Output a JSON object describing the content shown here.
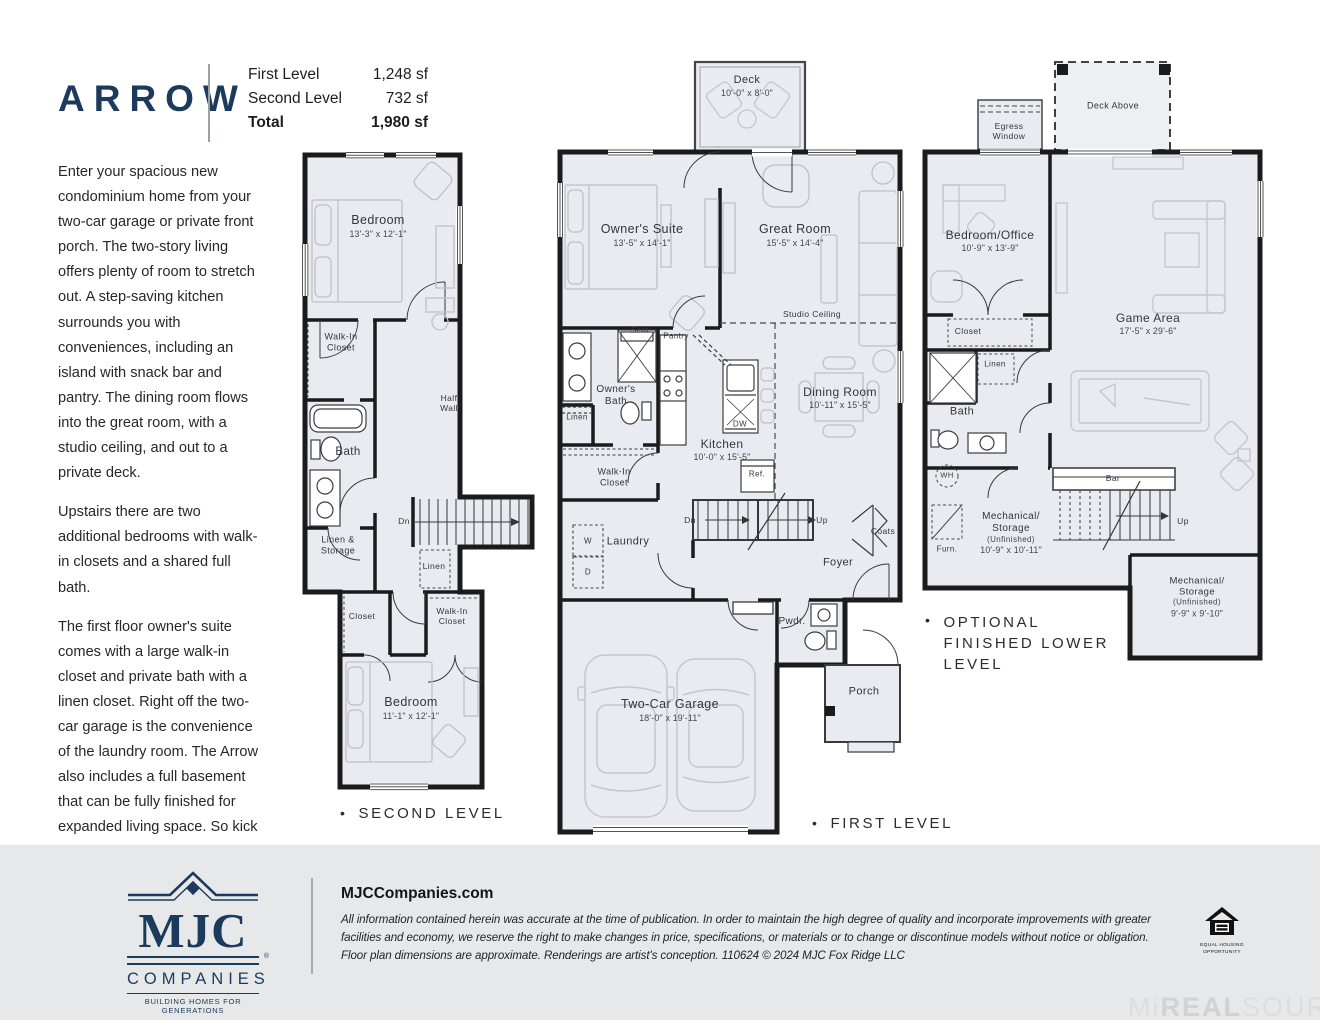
{
  "bullet": "•",
  "header": {
    "title": "ARROW",
    "stats": [
      {
        "label": "First Level",
        "value": "1,248 sf"
      },
      {
        "label": "Second Level",
        "value": "732 sf"
      },
      {
        "label": "Total",
        "value": "1,980 sf"
      }
    ]
  },
  "description": {
    "p1": "Enter your spacious new condominium home from your two-car garage or private front porch. The two-story living offers plenty of room to stretch out. A step-saving kitchen surrounds you with conveniences, including an island with snack bar and pantry. The dining room flows into the great room, with a studio ceiling, and out to a private deck.",
    "p2": "Upstairs there are two additional bedrooms with walk-in closets and a shared full bath.",
    "p3": "The first floor owner's suite comes with a large walk-in closet and private bath with a linen closet. Right off the two-car garage is the convenience of the laundry room. The Arrow also includes a full basement that can be fully finished for expanded living space. So kick off your shoes and feel right at home!"
  },
  "plans": {
    "second": {
      "caption": "SECOND LEVEL",
      "bedroom1": {
        "n": "Bedroom",
        "d": "13'-3\" x 12'-1\""
      },
      "walkin1": "Walk-In Closet",
      "bath": "Bath",
      "half_wall": "Half Wall",
      "dn": "Dn",
      "linen_storage": "Linen & Storage",
      "linen": "Linen",
      "closet": "Closet",
      "walkin2": "Walk-In Closet",
      "bedroom2": {
        "n": "Bedroom",
        "d": "11'-1\" x 12'-1\""
      }
    },
    "first": {
      "caption": "FIRST LEVEL",
      "deck": {
        "n": "Deck",
        "d": "10'-0\" x 8'-0\""
      },
      "owners_suite": {
        "n": "Owner's Suite",
        "d": "13'-5\" x 14'-1\""
      },
      "great_room": {
        "n": "Great Room",
        "d": "15'-5\" x 14'-4\""
      },
      "studio_ceiling": "Studio Ceiling",
      "seat": "Seat",
      "pantry": "Pantry",
      "owners_bath": "Owner's Bath",
      "linen": "Linen",
      "walkin": "Walk-In Closet",
      "kitchen": {
        "n": "Kitchen",
        "d": "10'-0\" x 15'-5\""
      },
      "dw": "DW",
      "ref": "Ref.",
      "dining": {
        "n": "Dining Room",
        "d": "10'-11\" x 15'-5\""
      },
      "dn": "Dn",
      "up": "Up",
      "coats": "Coats",
      "foyer": "Foyer",
      "laundry": "Laundry",
      "w": "W",
      "d": "D",
      "garage": {
        "n": "Two-Car Garage",
        "d": "18'-0\" x 19'-11\""
      },
      "pwdr": "Pwdr.",
      "porch": "Porch"
    },
    "lower": {
      "caption": "OPTIONAL FINISHED LOWER LEVEL",
      "deck_above": "Deck Above",
      "egress": "Egress Window",
      "bedroom_office": {
        "n": "Bedroom/Office",
        "d": "10'-9\" x 13'-9\""
      },
      "game_area": {
        "n": "Game Area",
        "d": "17'-5\" x 29'-6\""
      },
      "closet": "Closet",
      "linen": "Linen",
      "bath": "Bath",
      "wh": "WH",
      "furn": "Furn.",
      "mech1": {
        "n1": "Mechanical/",
        "n2": "Storage",
        "s": "(Unfinished)",
        "d": "10'-9\" x 10'-11\""
      },
      "bar": "Bar",
      "up": "Up",
      "mech2": {
        "n1": "Mechanical/",
        "n2": "Storage",
        "s": "(Unfinished)",
        "d": "9'-9\" x 9'-10\""
      }
    }
  },
  "footer": {
    "logo": {
      "name": "MJC",
      "companies": "COMPANIES",
      "tagline": "BUILDING HOMES FOR GENERATIONS",
      "reg": "®"
    },
    "website": "MJCCompanies.com",
    "disclaimer": "All information contained herein was accurate at the time of publication. In order to maintain the high degree of quality and incorporate improvements with greater facilities and economy, we reserve the right to make changes in price, specifications, or materials or to change or discontinue models without notice or obligation. Floor plan dimensions are approximate. Renderings are artist's conception.  110624  © 2024 MJC Fox Ridge LLC",
    "eho": {
      "line1": "EQUAL HOUSING",
      "line2": "OPPORTUNITY"
    },
    "watermark": {
      "mi": "Mi",
      "real": "REAL",
      "source": "SOURCE"
    }
  }
}
